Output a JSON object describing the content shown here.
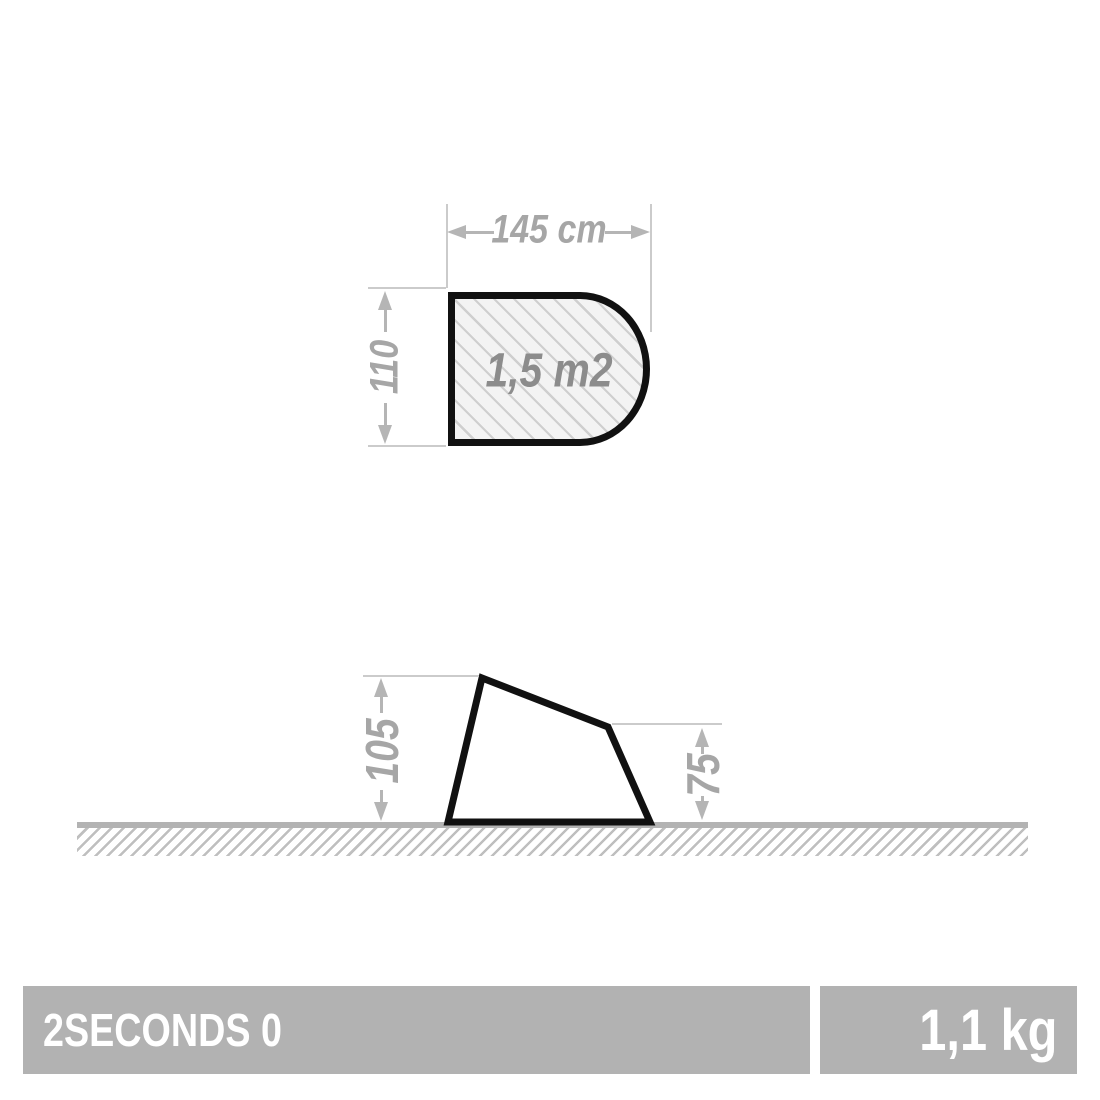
{
  "floor_plan": {
    "width_label": "145 cm",
    "depth_label": "110",
    "area_label": "1,5 m2"
  },
  "side_view": {
    "front_height_label": "105",
    "rear_height_label": "75"
  },
  "footer": {
    "product_name": "2SECONDS 0",
    "weight": "1,1 kg"
  },
  "colors": {
    "outline": "#111111",
    "dimension_text": "#a6a6a6",
    "arrow": "#b5b5b5",
    "extension_line": "#cbcbcb",
    "hatch_fill": "#f3f3f3",
    "hatch_line": "#cfcfcf",
    "ground": "#b3b3b3",
    "footer_bar": "#b2b2b2",
    "footer_text": "#ffffff",
    "area_text": "#8c8c8c"
  }
}
